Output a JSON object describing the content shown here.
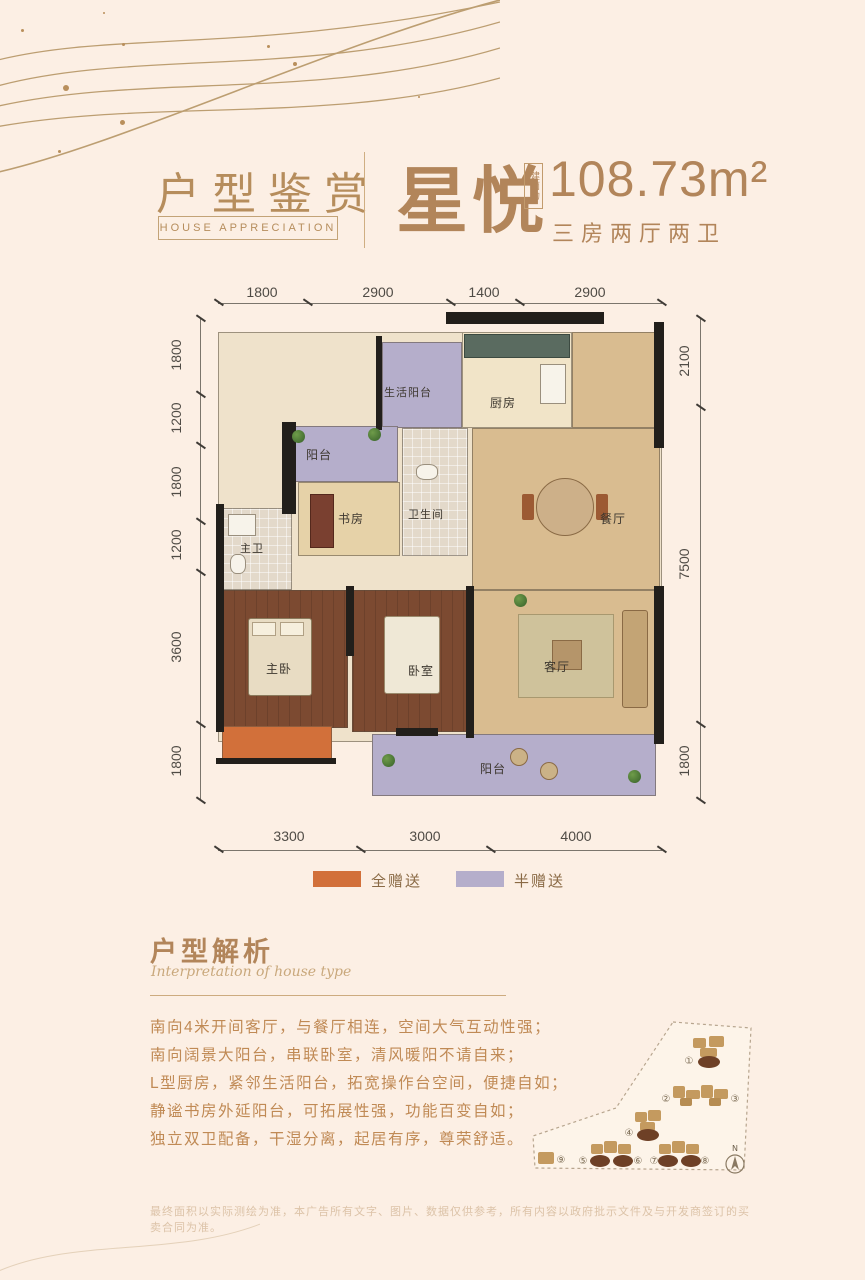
{
  "header": {
    "section_title": "户型鉴赏",
    "section_subtitle": "HOUSE APPRECIATION",
    "unit_name": "星悦",
    "area_prefix": "建面约",
    "area_value": "108.73m²",
    "unit_layout": "三房两厅两卫"
  },
  "floorplan": {
    "dimensions": {
      "top": [
        "1800",
        "2900",
        "1400",
        "2900"
      ],
      "left": [
        "1800",
        "1200",
        "1800",
        "1200",
        "3600",
        "1800"
      ],
      "right": [
        "2100",
        "7500",
        "1800"
      ],
      "bottom": [
        "3300",
        "3000",
        "4000"
      ]
    },
    "rooms": [
      {
        "label": "生活阳台"
      },
      {
        "label": "厨房"
      },
      {
        "label": "阳台"
      },
      {
        "label": "书房"
      },
      {
        "label": "卫生间"
      },
      {
        "label": "餐厅"
      },
      {
        "label": "主卫"
      },
      {
        "label": "主卧"
      },
      {
        "label": "卧室"
      },
      {
        "label": "客厅"
      },
      {
        "label": "阳台"
      }
    ],
    "legend": [
      {
        "label": "全赠送",
        "color": "#d2703a"
      },
      {
        "label": "半赠送",
        "color": "#b5aecb"
      }
    ]
  },
  "analysis": {
    "title": "户型解析",
    "subtitle": "Interpretation of house type",
    "features": [
      "南向4米开间客厅，与餐厅相连，空间大气互动性强；",
      "南向阔景大阳台，串联卧室，清风暖阳不请自来；",
      "L型厨房，紧邻生活阳台，拓宽操作台空间，便捷自如；",
      "静谧书房外延阳台，可拓展性强，功能百变自如；",
      "独立双卫配备，干湿分离，起居有序，尊荣舒适。"
    ]
  },
  "sitemap": {
    "building_numbers": [
      "①",
      "②",
      "③",
      "④",
      "⑤",
      "⑥",
      "⑦",
      "⑧",
      "⑨"
    ],
    "compass_label": "N"
  },
  "disclaimer": "最终面积以实际测绘为准，本广告所有文字、图片、数据仅供参考，所有内容以政府批示文件及与开发商签订的买卖合同为准。"
}
